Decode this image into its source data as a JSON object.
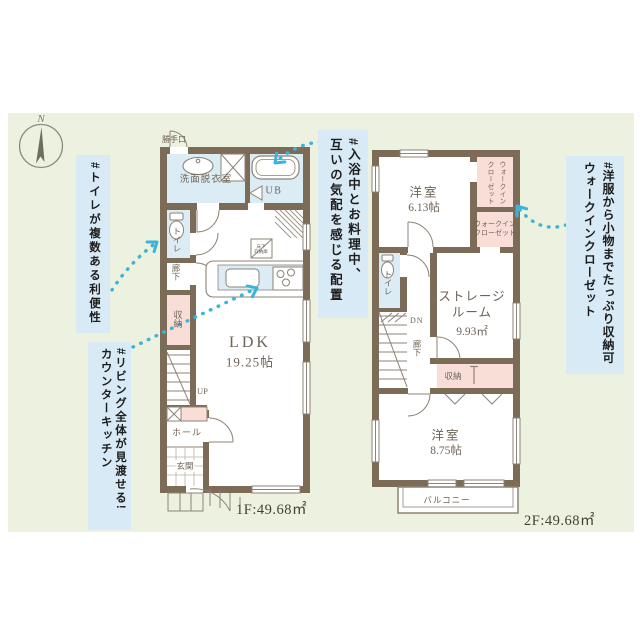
{
  "palette": {
    "panel_bg": "#ecf1e0",
    "annotation_bg": "#d7eaf5",
    "wall": "#7b6b57",
    "wet_room": "#dbecf4",
    "closet_pink": "#f9ded8",
    "arrow_accent": "#3cb4da"
  },
  "compass": {
    "north_label": "N"
  },
  "annotations": {
    "toilet": "#トイレが複数ある利便性",
    "bath_kitchen": "#入浴中とお料理中、\n互いの気配を感じる配置",
    "counter_kitchen": "#リビング全体が見渡せる!\nカウンターキッチン",
    "walk_in_closet": "#洋服から小物までたっぷり収納可\nウォークインクローゼット"
  },
  "floor1": {
    "area_label": "1F:49.68㎡",
    "ldk_name": "LDK",
    "ldk_size": "19.25帖",
    "washroom": "洗面脱衣室",
    "bath": "UB",
    "back_door": "勝手口",
    "toilet": "トイレ",
    "corridor": "廊下",
    "storage": "収納",
    "stairs_up": "UP",
    "hall": "ホール",
    "entrance": "玄関",
    "underfloor_storage": "床下\n収納庫"
  },
  "floor2": {
    "area_label": "2F:49.68㎡",
    "bedroom1_name": "洋室",
    "bedroom1_size": "6.13帖",
    "wic_vertical": "ウォークイン\nクローゼット",
    "wic_horizontal": "ウォークイン\nクローゼット",
    "toilet": "トイレ",
    "stairs_down": "DN",
    "corridor": "廊下",
    "storage_room_name": "ストレージ\nルーム",
    "storage_room_size": "9.93㎡",
    "closet": "収納",
    "bedroom2_name": "洋室",
    "bedroom2_size": "8.75帖",
    "balcony": "バルコニー"
  }
}
